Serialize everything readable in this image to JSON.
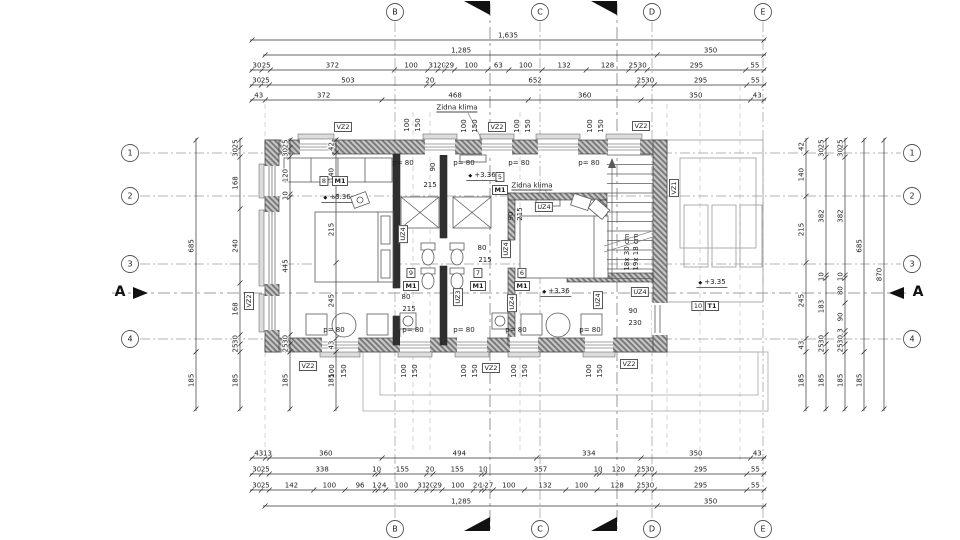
{
  "grid": {
    "columns": [
      "B",
      "C",
      "D",
      "E"
    ],
    "rows": [
      "1",
      "2",
      "3",
      "4"
    ],
    "section": "A"
  },
  "chains": {
    "top": [
      [
        "1,635"
      ],
      [
        "1,285",
        "350"
      ],
      [
        "30",
        "25",
        "372",
        "100",
        "31",
        "20",
        "29",
        "100",
        "63",
        "100",
        "132",
        "128",
        "25",
        "30",
        "295",
        "55"
      ],
      [
        "30",
        "25",
        "503",
        "20",
        "652",
        "25",
        "30",
        "295",
        "55"
      ],
      [
        "43",
        "372",
        "468",
        "360",
        "350",
        "43"
      ]
    ],
    "bottom": [
      [
        "43",
        "13",
        "360",
        "494",
        "334",
        "350",
        "43"
      ],
      [
        "30",
        "25",
        "338",
        "10",
        "155",
        "20",
        "155",
        "10",
        "357",
        "10",
        "120",
        "25",
        "30",
        "295",
        "55"
      ],
      [
        "30",
        "25",
        "142",
        "100",
        "96",
        "10",
        "24",
        "100",
        "31",
        "20",
        "29",
        "100",
        "26",
        "10",
        "27",
        "100",
        "132",
        "100",
        "128",
        "25",
        "30",
        "295",
        "55"
      ],
      [
        "1,285",
        "350"
      ]
    ],
    "left": [
      [
        "685",
        "185"
      ],
      [
        "25",
        "30",
        "168",
        "240",
        "168",
        "30",
        "25",
        "185"
      ],
      [
        "25",
        "30",
        "120",
        "10",
        "445",
        "30",
        "25",
        "185"
      ],
      [
        "42",
        "140",
        "215",
        "245",
        "43",
        "185"
      ]
    ],
    "right": [
      [
        "42",
        "140",
        "215",
        "245",
        "43",
        "185"
      ],
      [
        "25",
        "30",
        "382",
        "10",
        "183",
        "30",
        "25",
        "185"
      ],
      [
        "25",
        "30",
        "382",
        "10",
        "80",
        "90",
        "13",
        "30",
        "25",
        "185"
      ],
      [
        "685",
        "185"
      ],
      [
        "870"
      ]
    ]
  },
  "annotations": [
    {
      "id": "vz2_t1",
      "text": "VZ2"
    },
    {
      "id": "vz2_t2",
      "text": "VZ2"
    },
    {
      "id": "vz2_t3",
      "text": "VZ2"
    },
    {
      "id": "vz1_r",
      "text": "VZ1"
    },
    {
      "id": "vz2_l",
      "text": "VZ2"
    },
    {
      "id": "vz2_b1",
      "text": "VZ2"
    },
    {
      "id": "vz2_b2",
      "text": "VZ2"
    },
    {
      "id": "vz2_b3",
      "text": "VZ2"
    },
    {
      "id": "uz4_a",
      "text": "UZ4"
    },
    {
      "id": "uz4_b",
      "text": "UZ4"
    },
    {
      "id": "uz4_c",
      "text": "UZ4"
    },
    {
      "id": "uz4_d",
      "text": "UZ4"
    },
    {
      "id": "uz4_e",
      "text": "UZ4"
    },
    {
      "id": "uz4_f",
      "text": "UZ4"
    },
    {
      "id": "uz3_a",
      "text": "UZ3"
    },
    {
      "id": "room8_no",
      "text": "8"
    },
    {
      "id": "room8_type",
      "text": "M1"
    },
    {
      "id": "room5_no",
      "text": "5"
    },
    {
      "id": "room5_type",
      "text": "M1"
    },
    {
      "id": "room9_no",
      "text": "9"
    },
    {
      "id": "room9_type",
      "text": "M1"
    },
    {
      "id": "room7_no",
      "text": "7"
    },
    {
      "id": "room7_type",
      "text": "M1"
    },
    {
      "id": "room6_no",
      "text": "6"
    },
    {
      "id": "room6_type",
      "text": "M1"
    },
    {
      "id": "room10_no",
      "text": "10"
    },
    {
      "id": "room10_type",
      "text": "T1"
    },
    {
      "id": "klima1",
      "text": "Zidna klima"
    },
    {
      "id": "klima2",
      "text": "Zidna klima"
    },
    {
      "id": "lvl1",
      "text": "+3.36"
    },
    {
      "id": "lvl2",
      "text": "+3.36"
    },
    {
      "id": "lvl3",
      "text": "+3.36"
    },
    {
      "id": "lvl4",
      "text": "+3.35"
    },
    {
      "id": "door1_w",
      "text": "80"
    },
    {
      "id": "door1_h",
      "text": "215"
    },
    {
      "id": "door2_w",
      "text": "80"
    },
    {
      "id": "door2_h",
      "text": "215"
    },
    {
      "id": "door3_w",
      "text": "90"
    },
    {
      "id": "door3_h",
      "text": "215"
    },
    {
      "id": "door4_w",
      "text": "90"
    },
    {
      "id": "door4_h",
      "text": "215"
    },
    {
      "id": "door5_w",
      "text": "90"
    },
    {
      "id": "door5_h",
      "text": "230"
    },
    {
      "id": "par_t1",
      "text": "p= 80"
    },
    {
      "id": "par_t2",
      "text": "p= 80"
    },
    {
      "id": "par_t3",
      "text": "p= 80"
    },
    {
      "id": "par_t4",
      "text": "p= 80"
    },
    {
      "id": "par_b1",
      "text": "p= 80"
    },
    {
      "id": "par_b2",
      "text": "p= 80"
    },
    {
      "id": "par_b3",
      "text": "p= 80"
    },
    {
      "id": "par_b4",
      "text": "p= 80"
    },
    {
      "id": "par_b5",
      "text": "p= 80"
    },
    {
      "id": "wt1a",
      "text": "100"
    },
    {
      "id": "wt1b",
      "text": "150"
    },
    {
      "id": "wt2a",
      "text": "100"
    },
    {
      "id": "wt2b",
      "text": "150"
    },
    {
      "id": "wt3a",
      "text": "100"
    },
    {
      "id": "wt3b",
      "text": "150"
    },
    {
      "id": "wt4a",
      "text": "100"
    },
    {
      "id": "wt4b",
      "text": "150"
    },
    {
      "id": "wb1a",
      "text": "100"
    },
    {
      "id": "wb1b",
      "text": "150"
    },
    {
      "id": "wb2a",
      "text": "100"
    },
    {
      "id": "wb2b",
      "text": "150"
    },
    {
      "id": "wb3a",
      "text": "100"
    },
    {
      "id": "wb3b",
      "text": "150"
    },
    {
      "id": "wb4a",
      "text": "100"
    },
    {
      "id": "wb4b",
      "text": "150"
    },
    {
      "id": "wb5a",
      "text": "100"
    },
    {
      "id": "wb5b",
      "text": "150"
    },
    {
      "id": "stair1",
      "text": "18x 30 cm"
    },
    {
      "id": "stair2",
      "text": "19x 18 cm"
    }
  ]
}
